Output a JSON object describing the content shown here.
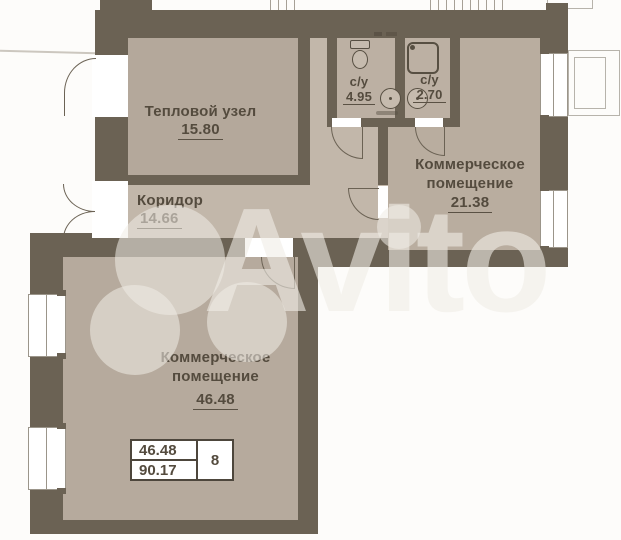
{
  "watermark": {
    "brand": "Avito"
  },
  "rooms": {
    "teplovoy": {
      "name": "Тепловой узел",
      "area": "15.80"
    },
    "koridor": {
      "name": "Коридор",
      "area": "14.66"
    },
    "su_left": {
      "name": "с/у",
      "area": "4.95"
    },
    "su_right": {
      "name": "с/у",
      "area": "2.70"
    },
    "kom21": {
      "name_line1": "Коммерческое",
      "name_line2": "помещение",
      "area": "21.38"
    },
    "kom46": {
      "name_line1": "Коммерческое",
      "name_line2": "помещение",
      "area": "46.48"
    }
  },
  "summary_table": {
    "row1": "46.48",
    "row2": "90.17",
    "unit": "8"
  },
  "colors": {
    "wall": "#6b6254",
    "floor": "#b8ac9f",
    "corridor_floor": "#c2b7aa",
    "text": "#544b3e",
    "background": "#fdfcfa"
  }
}
